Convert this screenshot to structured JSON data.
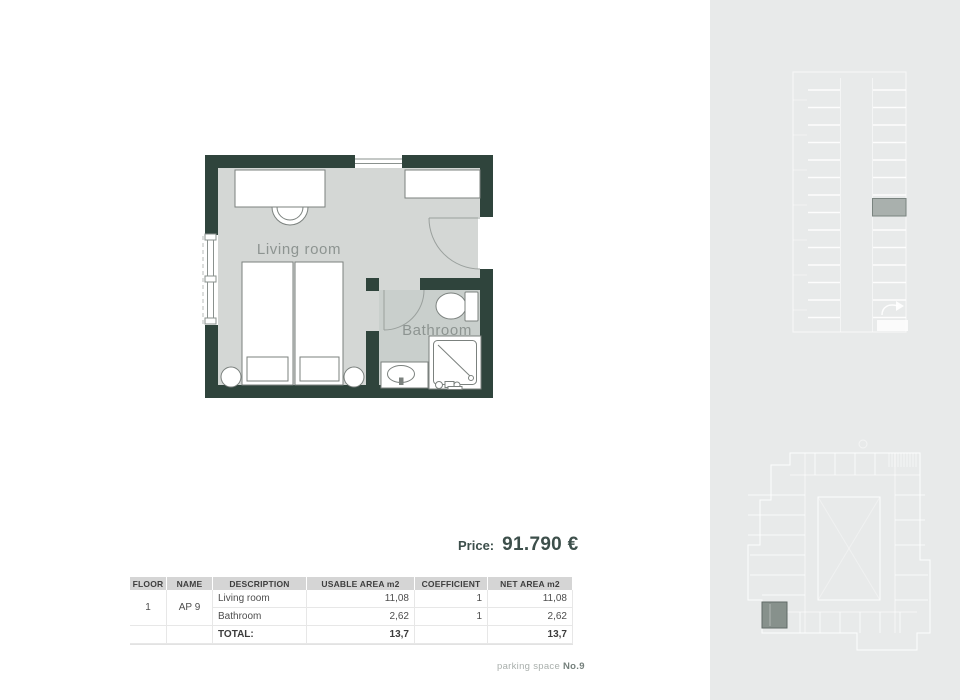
{
  "floor_plan": {
    "rooms": [
      {
        "label": "Living room"
      },
      {
        "label": "Bathroom"
      }
    ]
  },
  "price": {
    "label": "Price:",
    "value": "91.790 €"
  },
  "area_table": {
    "headers": [
      "FLOOR",
      "NAME",
      "DESCRIPTION",
      "USABLE AREA m2",
      "COEFFICIENT",
      "NET AREA m2"
    ],
    "floor": "1",
    "apartment": "AP 9",
    "rows": [
      {
        "description": "Living room",
        "usable_area": "11,08",
        "coefficient": "1",
        "net_area": "11,08"
      },
      {
        "description": "Bathroom",
        "usable_area": "2,62",
        "coefficient": "1",
        "net_area": "2,62"
      }
    ],
    "total": {
      "label": "TOTAL:",
      "usable_area": "13,7",
      "net_area": "13,7"
    }
  },
  "footer": {
    "parking_label": "parking space ",
    "parking_number": "No.9"
  },
  "colors": {
    "wall": "#2f443c",
    "floor": "#d4d7d5",
    "bathroom_floor": "#c9cfcc",
    "sidebar_bg": "#e8eaea",
    "parking_highlight": "#a9b0ad",
    "minimap_highlight": "#87918c",
    "accent_text": "#3d4f4b"
  }
}
